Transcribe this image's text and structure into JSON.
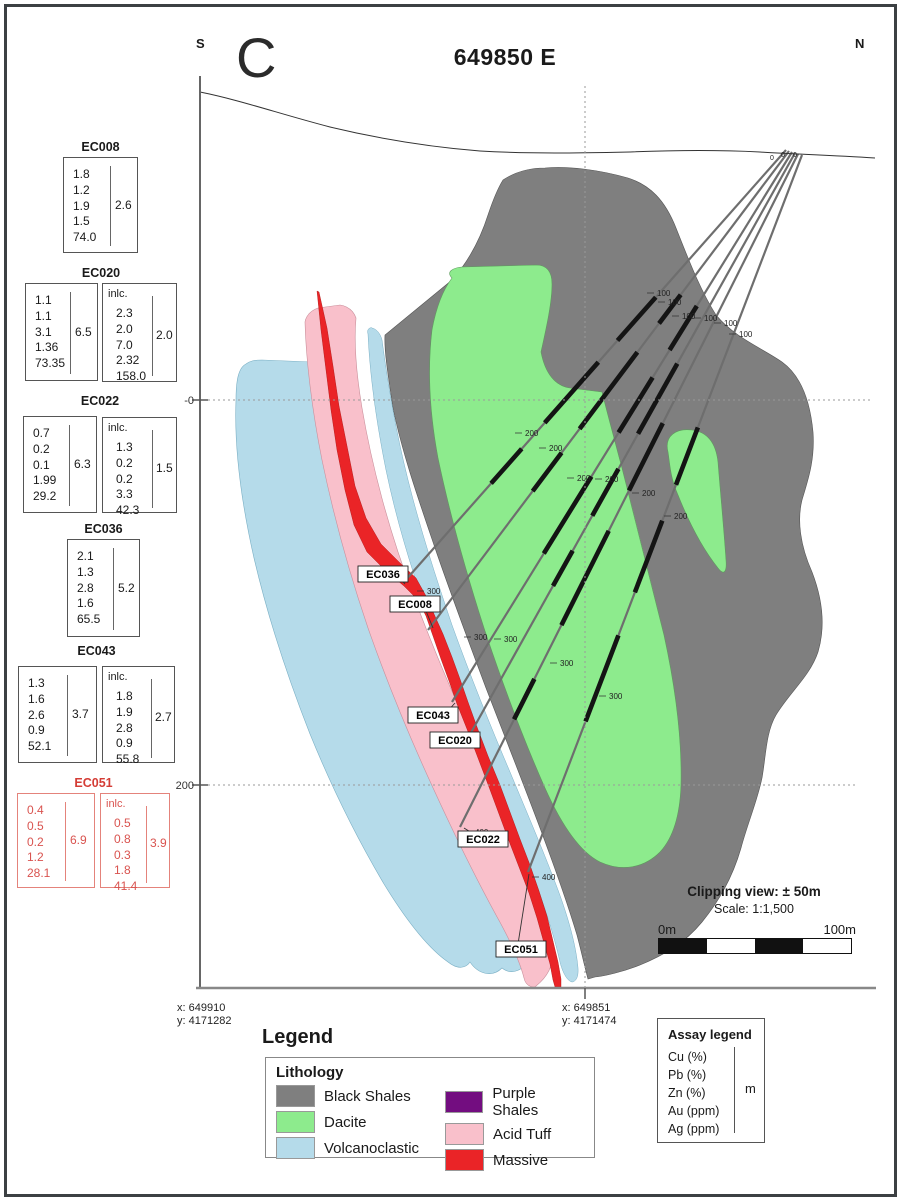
{
  "header": {
    "left_dir": "S",
    "right_dir": "N",
    "big_letter": "C",
    "title": "649850 E"
  },
  "axis": {
    "elev0": "-0",
    "elev200": "200",
    "coord_left": [
      "x: 649910",
      "y: 4171282"
    ],
    "coord_right": [
      "x: 649851",
      "y: 4171474"
    ]
  },
  "assays": [
    {
      "hole": "EC008",
      "main": {
        "values": [
          "1.8",
          "1.2",
          "1.9",
          "1.5",
          "74.0"
        ],
        "total": "2.6"
      }
    },
    {
      "hole": "EC020",
      "main": {
        "values": [
          "1.1",
          "1.1",
          "3.1",
          "1.36",
          "73.35"
        ],
        "total": "6.5"
      },
      "incl": {
        "label": "inlc.",
        "values": [
          "2.3",
          "2.0",
          "7.0",
          "2.32",
          "158.0"
        ],
        "total": "2.0"
      }
    },
    {
      "hole": "EC022",
      "main": {
        "values": [
          "0.7",
          "0.2",
          "0.1",
          "1.99",
          "29.2"
        ],
        "total": "6.3"
      },
      "incl": {
        "label": "inlc.",
        "values": [
          "1.3",
          "0.2",
          "0.2",
          "3.3",
          "42.3"
        ],
        "total": "1.5"
      }
    },
    {
      "hole": "EC036",
      "main": {
        "values": [
          "2.1",
          "1.3",
          "2.8",
          "1.6",
          "65.5"
        ],
        "total": "5.2"
      }
    },
    {
      "hole": "EC043",
      "main": {
        "values": [
          "1.3",
          "1.6",
          "2.6",
          "0.9",
          "52.1"
        ],
        "total": "3.7"
      },
      "incl": {
        "label": "inlc.",
        "values": [
          "1.8",
          "1.9",
          "2.8",
          "0.9",
          "55.8"
        ],
        "total": "2.7"
      }
    },
    {
      "hole": "EC051",
      "main": {
        "values": [
          "0.4",
          "0.5",
          "0.2",
          "1.2",
          "28.1"
        ],
        "total": "6.9"
      },
      "incl": {
        "label": "inlc.",
        "values": [
          "0.5",
          "0.8",
          "0.3",
          "1.8",
          "41.4"
        ],
        "total": "3.9"
      }
    }
  ],
  "section": {
    "hole_labels": [
      "EC036",
      "EC008",
      "EC043",
      "EC020",
      "EC022",
      "EC051"
    ],
    "tick_labels": {
      "t0": "0",
      "t100": "100",
      "t200": "200",
      "t300": "300",
      "t400": "400"
    }
  },
  "info": {
    "clipping": "Clipping view: ± 50m",
    "scale": "Scale: 1:1,500",
    "bar_left": "0m",
    "bar_right": "100m"
  },
  "legend": {
    "heading": "Legend",
    "litho_title": "Lithology",
    "items": [
      "Black Shales",
      "Dacite",
      "Volcanoclastic",
      "Purple Shales",
      "Acid Tuff",
      "Massive"
    ]
  },
  "assay_legend": {
    "title": "Assay legend",
    "rows": [
      "Cu (%)",
      "Pb (%)",
      "Zn (%)",
      "Au (ppm)",
      "Ag (ppm)"
    ],
    "unit": "m"
  },
  "colors": {
    "black_shales": "#7f7f7f",
    "dacite": "#8deb8d",
    "volcanoclastic": "#b5dbea",
    "purple_shales": "#730d80",
    "acid_tuff": "#f9c0cb",
    "massive": "#ea2427",
    "trace": "#6e6e6e",
    "interval": "#141414",
    "axis": "#666666"
  }
}
